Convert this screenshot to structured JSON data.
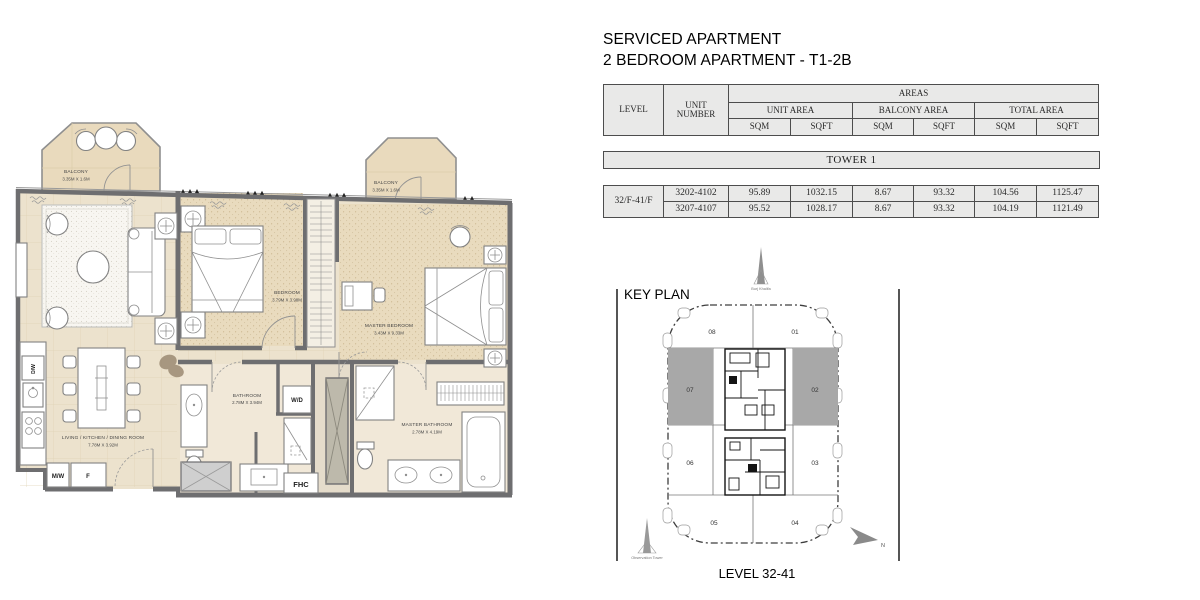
{
  "header": {
    "line1": "SERVICED APARTMENT",
    "line2": "2 BEDROOM APARTMENT - T1-2B"
  },
  "table": {
    "col_headers": {
      "level": "LEVEL",
      "unit_number": "UNIT NUMBER",
      "areas": "AREAS",
      "unit_area": "UNIT AREA",
      "balcony_area": "BALCONY AREA",
      "total_area": "TOTAL AREA",
      "sqm": "SQM",
      "sqft": "SQFT"
    },
    "tower": "TOWER 1",
    "level_value": "32/F-41/F",
    "rows": [
      {
        "unit": "3202-4102",
        "unit_sqm": "95.89",
        "unit_sqft": "1032.15",
        "balcony_sqm": "8.67",
        "balcony_sqft": "93.32",
        "total_sqm": "104.56",
        "total_sqft": "1125.47"
      },
      {
        "unit": "3207-4107",
        "unit_sqm": "95.52",
        "unit_sqft": "1028.17",
        "balcony_sqm": "8.67",
        "balcony_sqft": "93.32",
        "total_sqm": "104.19",
        "total_sqft": "1121.49"
      }
    ]
  },
  "key_plan": {
    "title": "KEY PLAN",
    "caption": "LEVEL 32-41",
    "landmark_top": "Burj Khalifa",
    "landmark_bottom": "Observation Tower",
    "north": "N",
    "units": [
      "08",
      "01",
      "07",
      "02",
      "06",
      "03",
      "05",
      "04"
    ],
    "highlighted_units": "07, 02",
    "highlight_color": "#a8a8a8"
  },
  "floor_plan": {
    "balcony_left": {
      "name": "BALCONY",
      "dims": "3.35M X 1.6M"
    },
    "balcony_right": {
      "name": "BALCONY",
      "dims": "3.35M X 1.6M"
    },
    "bedroom": {
      "name": "BEDROOM",
      "dims": "3.79M X 3.98M"
    },
    "master_bedroom": {
      "name": "MASTER BEDROOM",
      "dims": "3.43M X 9.33M"
    },
    "living_kitchen_dining": {
      "name": "LIVING / KITCHEN / DINING ROOM",
      "dims": "7.78M X 3.92M"
    },
    "bathroom": {
      "name": "BATHROOM",
      "dims": "2.78M X 3.94M"
    },
    "master_bathroom": {
      "name": "MASTER BATHROOM",
      "dims": "2.78M X 4.19M"
    },
    "tags": {
      "washer_dryer": "W/D",
      "fire_hose_cabinet": "FHC",
      "microwave": "M/W",
      "fridge": "F",
      "dishwasher": "D/W"
    }
  },
  "colors": {
    "wall": "#6e6e70",
    "floor": "#ece2cd",
    "bedroom_floor": "#e9dbbe",
    "balcony_floor": "#e9dabd",
    "table_cell": "#e9e9e8",
    "table_border": "#4d4d4d",
    "keyplan_highlight": "#a8a8a8"
  }
}
